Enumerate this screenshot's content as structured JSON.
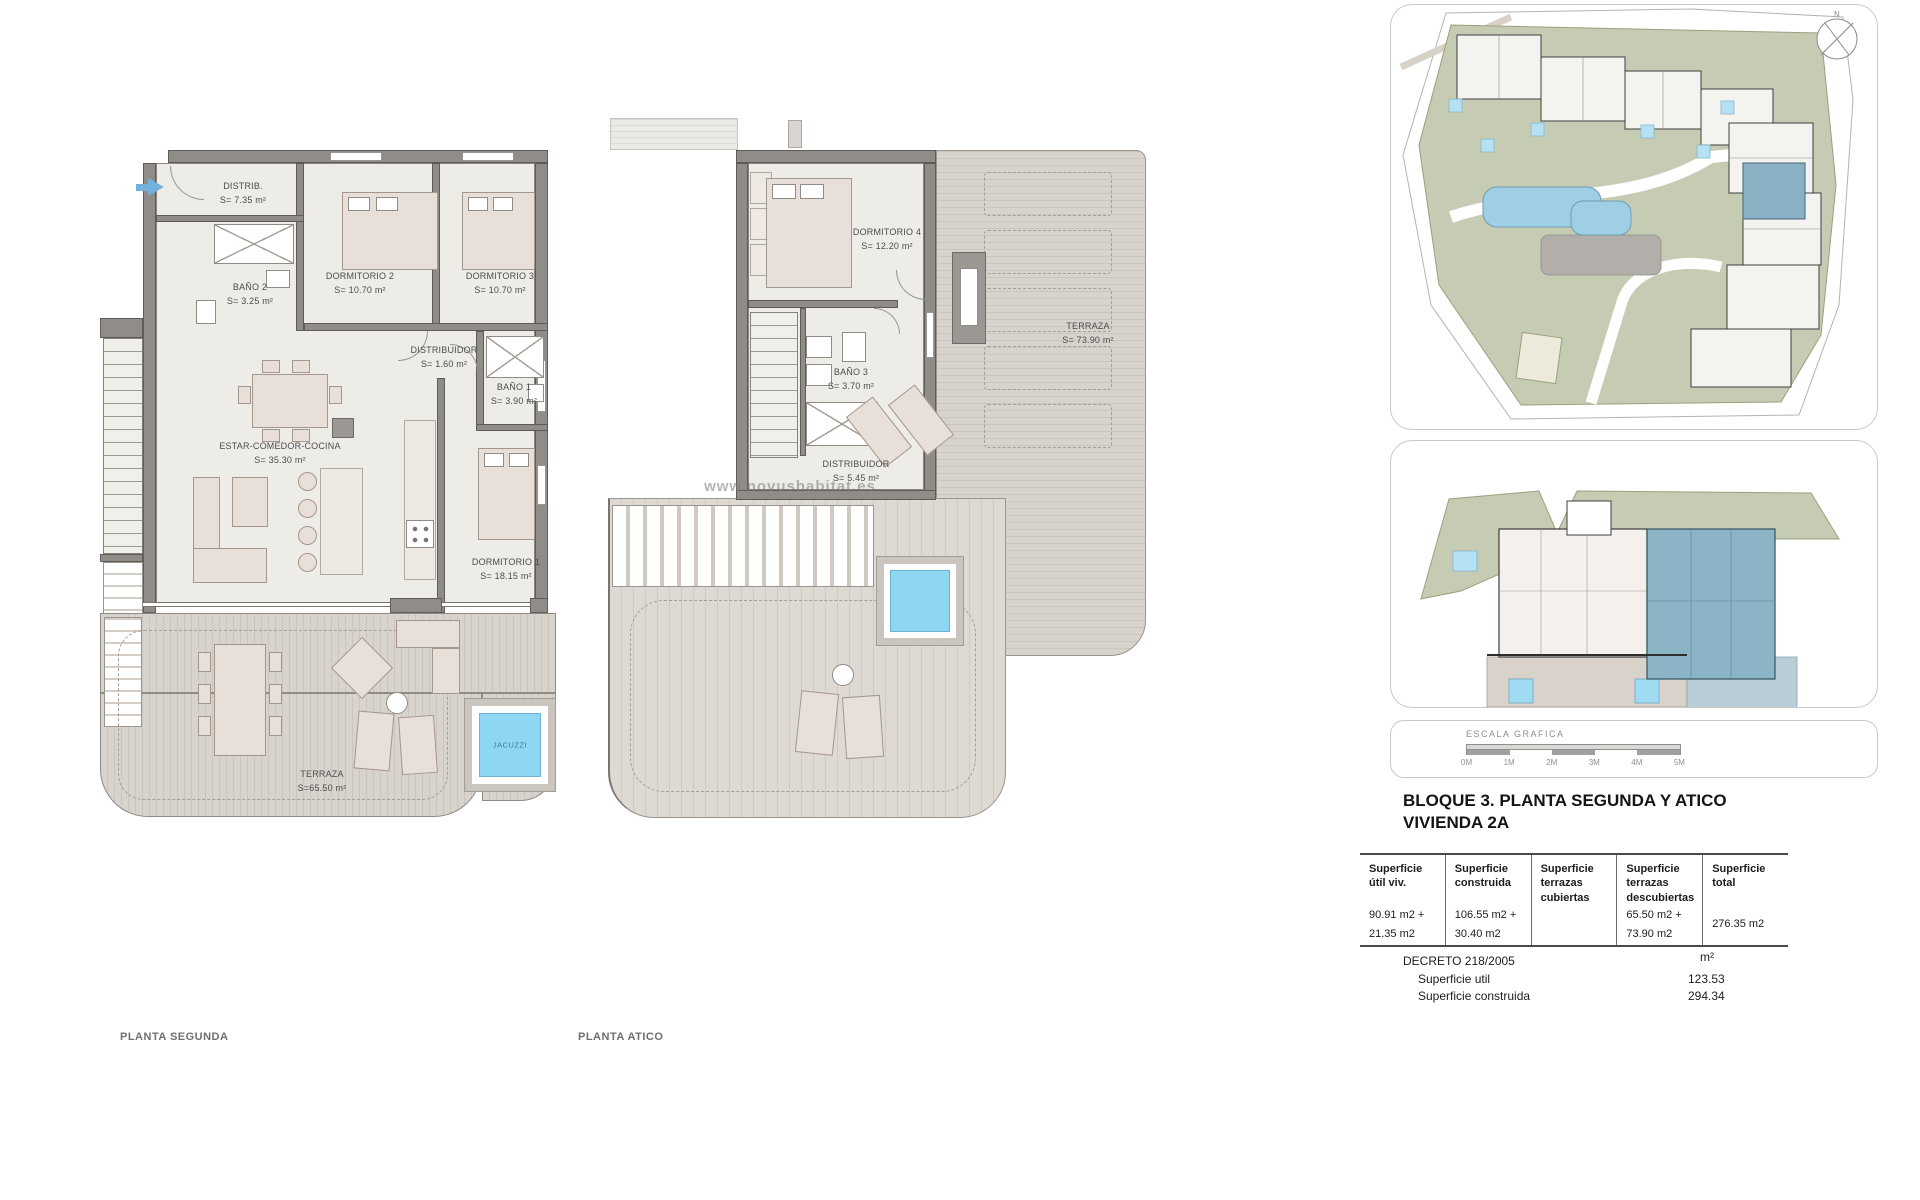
{
  "planta_segunda": {
    "caption": "PLANTA SEGUNDA",
    "rooms": [
      {
        "name": "DISTRIB.",
        "area": "S= 7.35 m²"
      },
      {
        "name": "BAÑO 2",
        "area": "S= 3.25 m²"
      },
      {
        "name": "DORMITORIO 2",
        "area": "S= 10.70 m²"
      },
      {
        "name": "DORMITORIO 3",
        "area": "S= 10.70 m²"
      },
      {
        "name": "DISTRIBUIDOR",
        "area": "S= 1.60 m²"
      },
      {
        "name": "BAÑO 1",
        "area": "S= 3.90 m²"
      },
      {
        "name": "ESTAR-COMEDOR-COCINA",
        "area": "S= 35.30 m²"
      },
      {
        "name": "DORMITORIO 1",
        "area": "S= 18.15 m²"
      },
      {
        "name": "TERRAZA",
        "area": "S=65.50 m²"
      },
      {
        "name": "JACUZZI",
        "area": ""
      }
    ]
  },
  "planta_atico": {
    "caption": "PLANTA ATICO",
    "watermark": "www.novushabitat.es",
    "rooms": [
      {
        "name": "DORMITORIO 4",
        "area": "S= 12.20 m²"
      },
      {
        "name": "BAÑO 3",
        "area": "S= 3.70 m²"
      },
      {
        "name": "DISTRIBUIDOR",
        "area": "S= 5.45 m²"
      },
      {
        "name": "TERRAZA",
        "area": "S= 73.90 m²"
      }
    ]
  },
  "site_plan": {
    "compass_label": "N"
  },
  "scale_bar": {
    "title": "ESCALA GRAFICA",
    "ticks": [
      "0M",
      "1M",
      "2M",
      "3M",
      "4M",
      "5M"
    ]
  },
  "info": {
    "title_line1": "BLOQUE 3. PLANTA SEGUNDA Y ATICO",
    "title_line2": "VIVIENDA 2A",
    "table": {
      "headers": [
        "Superficie útil viv.",
        "Superficie construida",
        "Superficie terrazas cubiertas",
        "Superficie terrazas descubiertas",
        "Superficie total"
      ],
      "values": [
        [
          "90.91 m2 +",
          "21.35 m2"
        ],
        [
          "106.55 m2 +",
          "30.40 m2"
        ],
        [
          "",
          ""
        ],
        [
          "65.50 m2 +",
          "73.90 m2"
        ],
        [
          "276.35 m2",
          ""
        ]
      ]
    },
    "decreto": {
      "title": "DECRETO 218/2005",
      "unit": "m²",
      "rows": [
        {
          "label": "Superficie util",
          "value": "123.53"
        },
        {
          "label": "Superficie construida",
          "value": "294.34"
        }
      ]
    }
  },
  "colors": {
    "jacuzzi_blue": "#8ed7f3",
    "unit_highlight_blue": "#8ab0c3",
    "site_green": "#c6ccb3",
    "pool_blue": "#9fcfe4"
  }
}
